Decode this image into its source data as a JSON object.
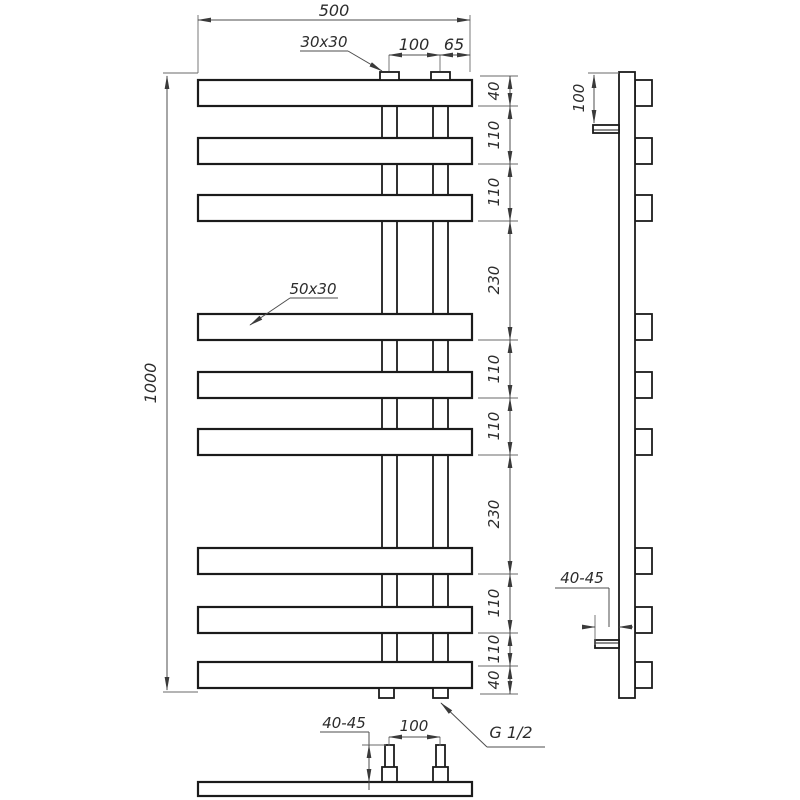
{
  "dims": {
    "width_top": "500",
    "pipe_spacing_top": "100",
    "pipe_edge_offset": "65",
    "height_overall": "1000",
    "right_chain": [
      "40",
      "110",
      "110",
      "230",
      "110",
      "110",
      "230",
      "110",
      "110",
      "40"
    ],
    "side_top_offset": "100",
    "side_wall_gap": "40-45",
    "bottom_wall_gap": "40-45",
    "bottom_pipe_spacing": "100"
  },
  "labels": {
    "vertical_profile": "30x30",
    "horizontal_profile": "50x30",
    "thread": "G 1/2"
  }
}
